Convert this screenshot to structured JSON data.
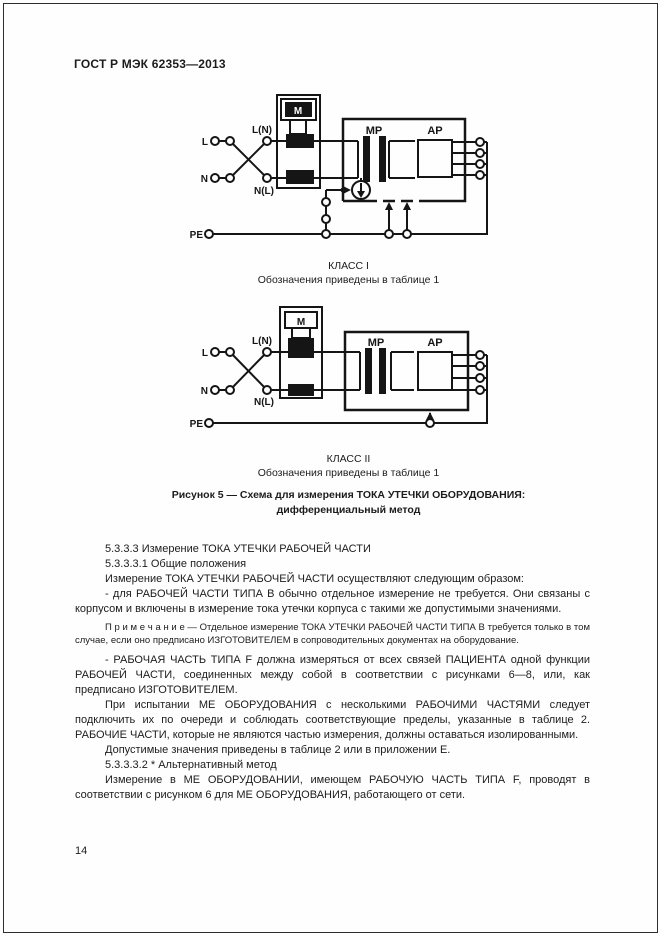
{
  "page": {
    "header": "ГОСТ Р МЭК 62353—2013",
    "page_number": "14"
  },
  "figure": {
    "diagram1": {
      "class_label": "КЛАСС I",
      "note": "Обозначения приведены в таблице 1",
      "labels": {
        "l": "L",
        "n": "N",
        "pe": "PE",
        "ln": "L(N)",
        "nl": "N(L)",
        "meter": "M",
        "mp": "МР",
        "ap": "АР"
      }
    },
    "diagram2": {
      "class_label": "КЛАСС II",
      "note": "Обозначения приведены в таблице 1",
      "labels": {
        "l": "L",
        "n": "N",
        "pe": "PE",
        "ln": "L(N)",
        "nl": "N(L)",
        "meter": "M",
        "mp": "МР",
        "ap": "АР"
      }
    },
    "caption_line1": "Рисунок 5 — Схема для измерения ТОКА УТЕЧКИ ОБОРУДОВАНИЯ:",
    "caption_line2": "дифференциальный метод"
  },
  "body": {
    "paragraphs": [
      "5.3.3.3  Измерение ТОКА УТЕЧКИ РАБОЧЕЙ ЧАСТИ",
      "5.3.3.3.1  Общие положения",
      "Измерение ТОКА УТЕЧКИ РАБОЧЕЙ ЧАСТИ осуществляют следующим образом:",
      "-  для РАБОЧЕЙ ЧАСТИ ТИПА В обычно отдельное измерение не требуется. Они связаны с корпусом и включены в измерение тока утечки корпуса с такими же допустимыми значениями.",
      "П р и м е ч а н и е — Отдельное измерение ТОКА УТЕЧКИ РАБОЧЕЙ ЧАСТИ ТИПА В требуется только в том случае, если оно предписано ИЗГОТОВИТЕЛЕМ в сопроводительных документах на оборудование.",
      "-  РАБОЧАЯ ЧАСТЬ ТИПА F должна измеряться от всех связей ПАЦИЕНТА одной функции РАБОЧЕЙ ЧАСТИ, соединенных между собой в соответствии с рисунками 6—8, или, как предписано ИЗГОТОВИТЕЛЕМ.",
      "При испытании МЕ ОБОРУДОВАНИЯ с несколькими РАБОЧИМИ ЧАСТЯМИ следует подключить их по очереди и соблюдать соответствующие пределы, указанные в таблице 2. РАБОЧИЕ ЧАСТИ, которые не являются частью измерения, должны оставаться изолированными.",
      "Допустимые значения приведены в таблице 2 или в приложении Е.",
      "5.3.3.3.2  * Альтернативный метод",
      "Измерение в МЕ ОБОРУДОВАНИИ, имеющем РАБОЧУЮ ЧАСТЬ ТИПА F, проводят в соответствии с рисунком 6 для МЕ ОБОРУДОВАНИЯ, работающего от сети."
    ]
  }
}
